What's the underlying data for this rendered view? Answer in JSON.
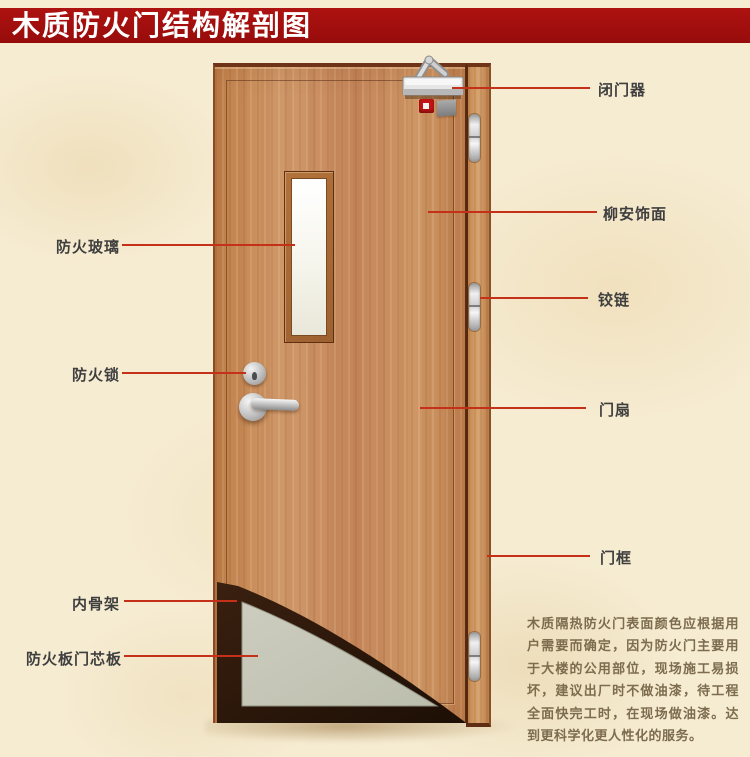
{
  "title": "木质防火门结构解剖图",
  "callouts": {
    "left": [
      {
        "id": "fire-glass",
        "label": "防火玻璃"
      },
      {
        "id": "fire-lock",
        "label": "防火锁"
      },
      {
        "id": "inner-skeleton",
        "label": "内骨架"
      },
      {
        "id": "fire-board-core",
        "label": "防火板门芯板"
      }
    ],
    "right": [
      {
        "id": "door-closer",
        "label": "闭门器"
      },
      {
        "id": "lauan-veneer",
        "label": "柳安饰面"
      },
      {
        "id": "hinge",
        "label": "铰链"
      },
      {
        "id": "door-leaf",
        "label": "门扇"
      },
      {
        "id": "door-frame",
        "label": "门框"
      }
    ]
  },
  "description": "木质隔热防火门表面颜色应根据用户需要而确定，因为防火门主要用于大楼的公用部位，现场施工易损坏，建议出厂时不做油漆，待工程全面快完工时，在现场做油漆。达到更科学化更人性化的服务。",
  "colors": {
    "banner": "#a30e0e",
    "leader_line": "#c53018",
    "door_wood": "#c98a58",
    "frame_wood": "#cf9a64",
    "core_panel": "#c8c8ba",
    "skeleton": "#2d180a",
    "background": "#f6ecd2",
    "label_text": "#3f3f3f",
    "description_text": "#7d6c4e"
  }
}
